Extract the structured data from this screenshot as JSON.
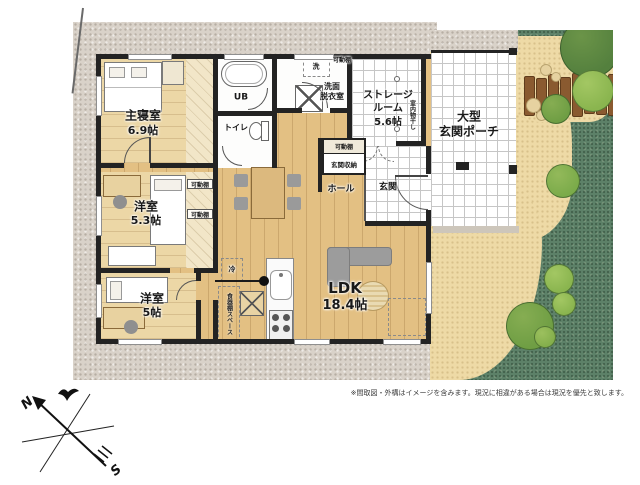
{
  "rooms": {
    "master_bedroom": {
      "name": "主寝室",
      "size": "6.9帖"
    },
    "bedroom2": {
      "name": "洋室",
      "size": "5.3帖"
    },
    "bedroom3": {
      "name": "洋室",
      "size": "5帖"
    },
    "ldk": {
      "name": "LDK",
      "size": "18.4帖"
    },
    "storage": {
      "line1": "ストレージ",
      "line2": "ルーム",
      "line3": "5.6帖"
    },
    "porch": {
      "line1": "大型",
      "line2": "玄関ポーチ"
    },
    "hall": {
      "name": "ホール"
    },
    "entrance": {
      "name": "玄関"
    },
    "unit_bath": {
      "name": "UB"
    },
    "toilet": {
      "name": "トイレ"
    },
    "washroom": {
      "line1": "洗面",
      "line2": "脱衣室"
    }
  },
  "fixtures": {
    "movable_shelf": "可動棚",
    "entrance_storage": "玄関収納",
    "indoor_drying": "室内物干し",
    "refrigerator": "冷",
    "washing_machine": "洗",
    "cupboard_space": "食器棚スペース"
  },
  "compass": {
    "north": "N",
    "south": "S"
  },
  "footer": {
    "disclaimer": "※間取図・外構はイメージを含みます。現況に相違がある場合は現況を優先と致します。"
  },
  "colors": {
    "wall": "#232323",
    "wood_floor": "#e3c083",
    "site_gray": "#d9d2c9",
    "garden_green": "#5d8168",
    "sand_path": "#eedaa6",
    "fence_brown": "#8a5a30",
    "sofa_gray": "#9c9c9c"
  }
}
